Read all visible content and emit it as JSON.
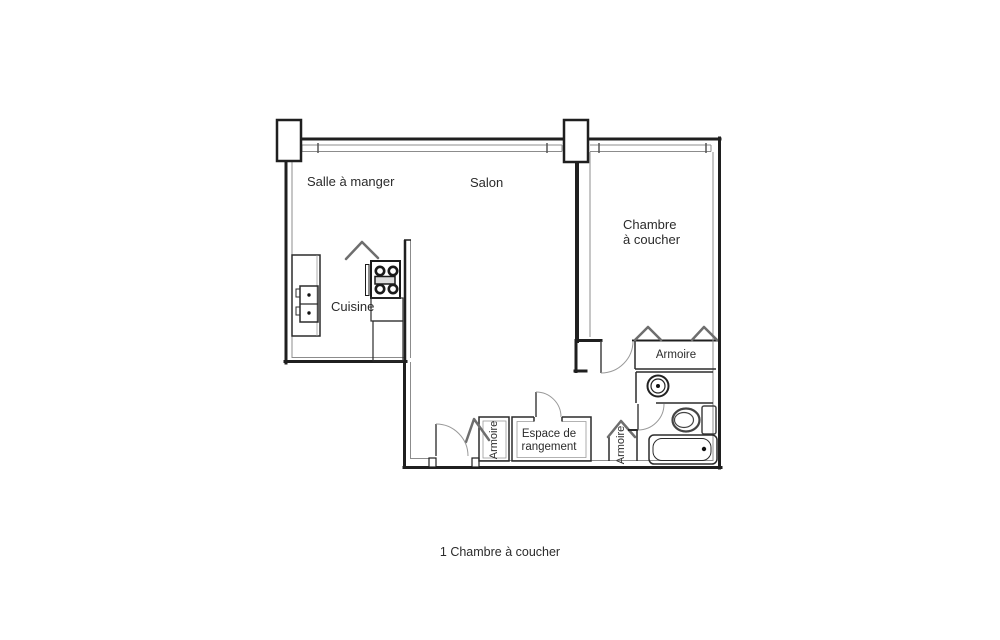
{
  "floor_plan": {
    "rooms": {
      "dining": {
        "label": "Salle à manger"
      },
      "living": {
        "label": "Salon"
      },
      "bedroom": {
        "label": "Chambre\nà coucher"
      },
      "kitchen": {
        "label": "Cuisine"
      },
      "bedroom_closet": {
        "label": "Armoire"
      },
      "entry_closet": {
        "label": "Armoire"
      },
      "hall_closet": {
        "label": "Armoire"
      },
      "storage": {
        "label": "Espace de\nrangement"
      }
    },
    "caption": "1 Chambre à coucher",
    "colors": {
      "wall": "#1f1f1f",
      "inner_line": "#8c8c8c",
      "door_arc": "#999999",
      "door_leaf": "#444444",
      "chevron": "#6e6e6e",
      "fixture": "#2b2b2b",
      "background": "#ffffff",
      "text": "#2b2b2b"
    }
  }
}
